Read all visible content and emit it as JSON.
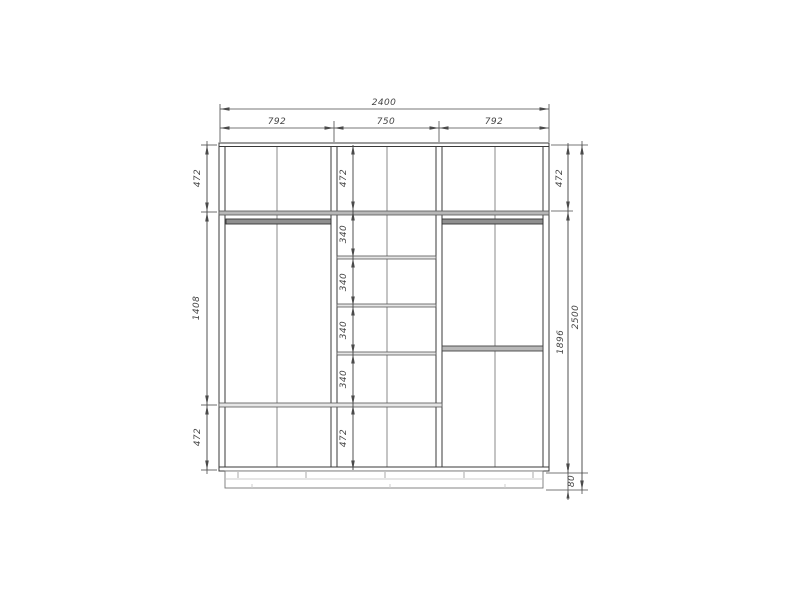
{
  "drawing": {
    "colors": {
      "object_line": "#3a3a3a",
      "dim_line": "#4a4a4a",
      "text": "#444444",
      "shelf_fill": "#b8b8b8",
      "rod_fill": "#8f8f8f",
      "panel_fill": "#ffffff",
      "background": "#ffffff"
    },
    "dims": {
      "total_width": "2400",
      "top_segments": [
        "792",
        "750",
        "792"
      ],
      "left_column": [
        "472",
        "1408",
        "472"
      ],
      "middle_column": [
        "472",
        "340",
        "340",
        "340",
        "340",
        "472"
      ],
      "right_column": [
        "472",
        "1896",
        "80"
      ],
      "total_height": "2500"
    }
  }
}
